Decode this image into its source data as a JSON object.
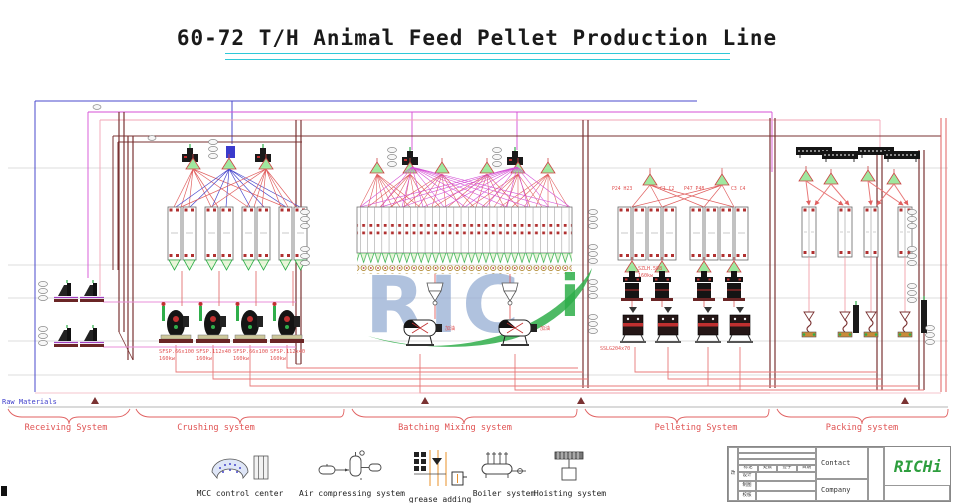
{
  "title": "60-72 T/H Animal Feed Pellet Production Line",
  "watermark_text": "RIC",
  "watermark_i": "i",
  "raw_materials_label": "Raw Materials",
  "section_labels": {
    "receiving": "Receiving System",
    "crushing": "Crushing system",
    "batching": "Batching Mixing system",
    "pelleting": "Pelleting System",
    "packing": "Packing system"
  },
  "machine_labels": {
    "crushers": [
      {
        "model": "SFSP.66x100",
        "power": "160kw"
      },
      {
        "model": "SFSP.112x40",
        "power": "160kw"
      },
      {
        "model": "SFSP.66x100",
        "power": "160kw"
      },
      {
        "model": "SFSP.112x40",
        "power": "160kw"
      }
    ],
    "pellet_mill": {
      "model": "SZLH.508",
      "power": "160kw"
    },
    "crumbler": "SSLG204x70",
    "pelleting_bin_tags": [
      "P24 H23",
      "C1 C2",
      "P47 P48",
      "C3 C4"
    ],
    "mixer_tags": [
      "加油",
      "加油"
    ]
  },
  "legend": {
    "items": [
      {
        "label": "MCC control center"
      },
      {
        "label": "Air compressing system"
      },
      {
        "label": "grease adding"
      },
      {
        "label": "Boiler system"
      },
      {
        "label": "Hoisting system"
      }
    ]
  },
  "title_block": {
    "revision": "改",
    "header_cells": [
      "标记",
      "处数",
      "签字",
      "日期"
    ],
    "row_labels": [
      "设计",
      "制图",
      "校核"
    ],
    "contact_label": "Contact",
    "company_label": "Company",
    "logo_text": "RICHi"
  },
  "colors": {
    "underline_cyan": "#2ec8d8",
    "line_red": "#e06060",
    "line_pink": "#f2a6b6",
    "line_magenta": "#d44fd4",
    "line_blue": "#4848cc",
    "dark_red": "#7a3232",
    "green": "#2fae4a",
    "watermark_blue": "#93abd2",
    "label_red": "#e05252",
    "raw_materials_blue": "#4040cc"
  }
}
